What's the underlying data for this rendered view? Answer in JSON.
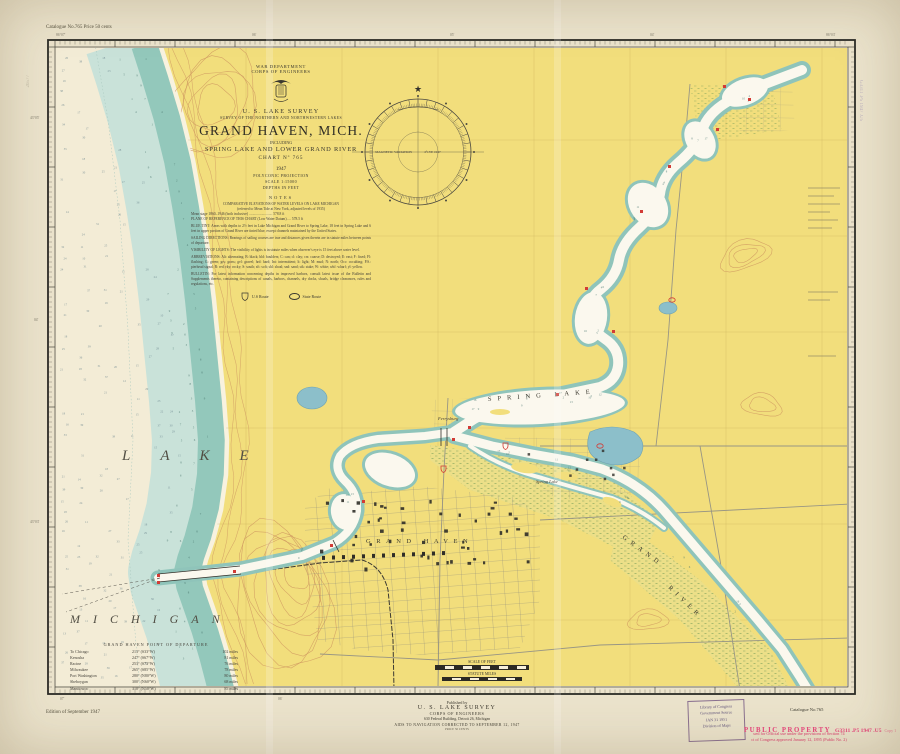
{
  "sheet": {
    "catalogue_top_left": "Catalogue  No.765  Price 50 cents",
    "edition_note": "Edition of September 1947",
    "catalogue_bottom_right": "Catalogue  No.765"
  },
  "title_block": {
    "department": "WAR DEPARTMENT",
    "corps": "CORPS OF ENGINEERS",
    "agency": "U. S. LAKE SURVEY",
    "survey_line": "SURVEY OF THE NORTHERN AND NORTHWESTERN LAKES",
    "title": "GRAND HAVEN, MICH.",
    "including": "INCLUDING",
    "subtitle": "SPRING LAKE AND LOWER GRAND RIVER",
    "chart_no": "CHART Nº 765",
    "year": "1947",
    "projection": "POLYCONIC PROJECTION",
    "scale": "SCALE 1:15000",
    "depths": "DEPTHS IN FEET",
    "notes_heading": "NOTES",
    "notes": [
      "COMPARATIVE ELEVATIONS OF WATER LEVELS ON LAKE MICHIGAN",
      "(referred to Mean Tide at New York, adjusted levels of 1935)",
      "Mean stage 1860–1946 (both inclusive) .......................... 578.8 ft",
      "PLANE OF REFERENCE OF THIS CHART (Low Water Datum) .... 578.5 ft",
      "BLUE TINT: Areas with depths to 2½ feet in Lake Michigan and Grand River to Spring Lake, 18 feet in Spring Lake and 6 feet in upper portion of Grand River are tinted blue, except channels maintained by the United States.",
      "SAILING DIRECTIONS: Bearings of sailing courses are true and distances given therein are in statute miles between points of departure.",
      "VISIBILITY OF LIGHTS: The visibility of lights is in statute miles when observer's eye is 15 feet above water level.",
      "ABBREVIATIONS: Alt: alternating; B: black; bld: boulders; C: can; cl: clay; crs: coarse; D: destroyed; E: east; F: fixed; Fl: flashing; G: green; grs: grass; gvl: gravel; hrd: hard; Int: intermittent; lt: light; M: mud; N: north; Occ: occulting; P.S.: pierhead signal; R: red; rky: rocky; S: south; sft: soft; shl: shoal; snd: sand; stk: stake; W: white; whf: wharf; yl: yellow.",
      "BULLETIN: For latest information concerning depths in improved harbors, consult latest issue of the Bulletin and Supplements thereto, containing descriptions of canals, harbors, channels, dry docks, shoals, bridge clearances, rules and regulations, etc."
    ],
    "legend_us_route": "U.S Route",
    "legend_state_route": "State Route"
  },
  "compass": {
    "label_left": "MAGNETIC VARIATION",
    "label_right": "4°15'E 1947"
  },
  "map_labels": {
    "lake": "LAKE",
    "michigan": "MICHIGAN",
    "grand_haven": "GRAND HAVEN",
    "spring_lake": "SPRING  LAKE",
    "grand_river_word1": "GRAND",
    "grand_river_word2": "RIVER",
    "spring_lake_village": "Spring Lake",
    "ferrysburg": "Ferrysburg"
  },
  "departure_table": {
    "title": "GRAND HAVEN POINT OF DEPARTURE",
    "rows": [
      {
        "to": "To  Chicago",
        "bearing": "213° (S33°W)",
        "distance": "102 miles"
      },
      {
        "to": "Kenosha",
        "bearing": "247° (S67°W)",
        "distance": "81 miles"
      },
      {
        "to": "Racine",
        "bearing": "253° (S73°W)",
        "distance": "76 miles"
      },
      {
        "to": "Milwaukee",
        "bearing": "265° (S85°W)",
        "distance": "78 miles"
      },
      {
        "to": "Port Washington",
        "bearing": "280° (N80°W)",
        "distance": "80 miles"
      },
      {
        "to": "Sheboygan",
        "bearing": "300° (N60°W)",
        "distance": "68 miles"
      },
      {
        "to": "Manitowoc",
        "bearing": "310° (N50°W)",
        "distance": "85 miles"
      }
    ]
  },
  "scale_bars": {
    "feet_label": "SCALE OF FEET",
    "miles_label": "STATUTE MILES"
  },
  "publisher": {
    "published_by": "Published  by",
    "agency": "U. S. LAKE SURVEY",
    "corps": "CORPS OF ENGINEERS",
    "address": "630 Federal Building, Detroit 26, Michigan",
    "correction": "AIDS TO NAVIGATION CORRECTED TO SEPTEMBER 12, 1947",
    "price": "PRICE 50 CENTS"
  },
  "stamps": {
    "loc_line1": "Library of Congress",
    "loc_line2": "Government Source",
    "loc_line3": "JAN 31 1951",
    "loc_line4": "Division of Maps",
    "public_property": "PUBLIC PROPERTY",
    "call_number": "G3311 .P5 1947 .U5",
    "copy": "Copy 1",
    "provision_line1": "ued for Official use under the provisions of Section 74",
    "provision_line2": "ct of Congress approved January 12, 1895 (Public No. 2)",
    "margin_right_vertical": "G3311 .P5 1947 .U5",
    "margin_left_vertical": "26577"
  },
  "border_labels": {
    "top": [
      "86°07'",
      "06'",
      "05'",
      "04'",
      "86°03'"
    ],
    "left": [
      "43°05'",
      "04'",
      "43°03'"
    ],
    "bottom": [
      "07'",
      "06'"
    ]
  },
  "colors": {
    "paper": "#ebe3cc",
    "land": "#f2de7c",
    "lake": "#f3ecd6",
    "shallow": "#93c8bb",
    "shoal_light": "#c9e2d9",
    "pond": "#8cbfca",
    "contour": "#d09a62",
    "accent_red": "#d23b35",
    "stamp_pink": "#e8457c",
    "ink": "#3a382f"
  }
}
